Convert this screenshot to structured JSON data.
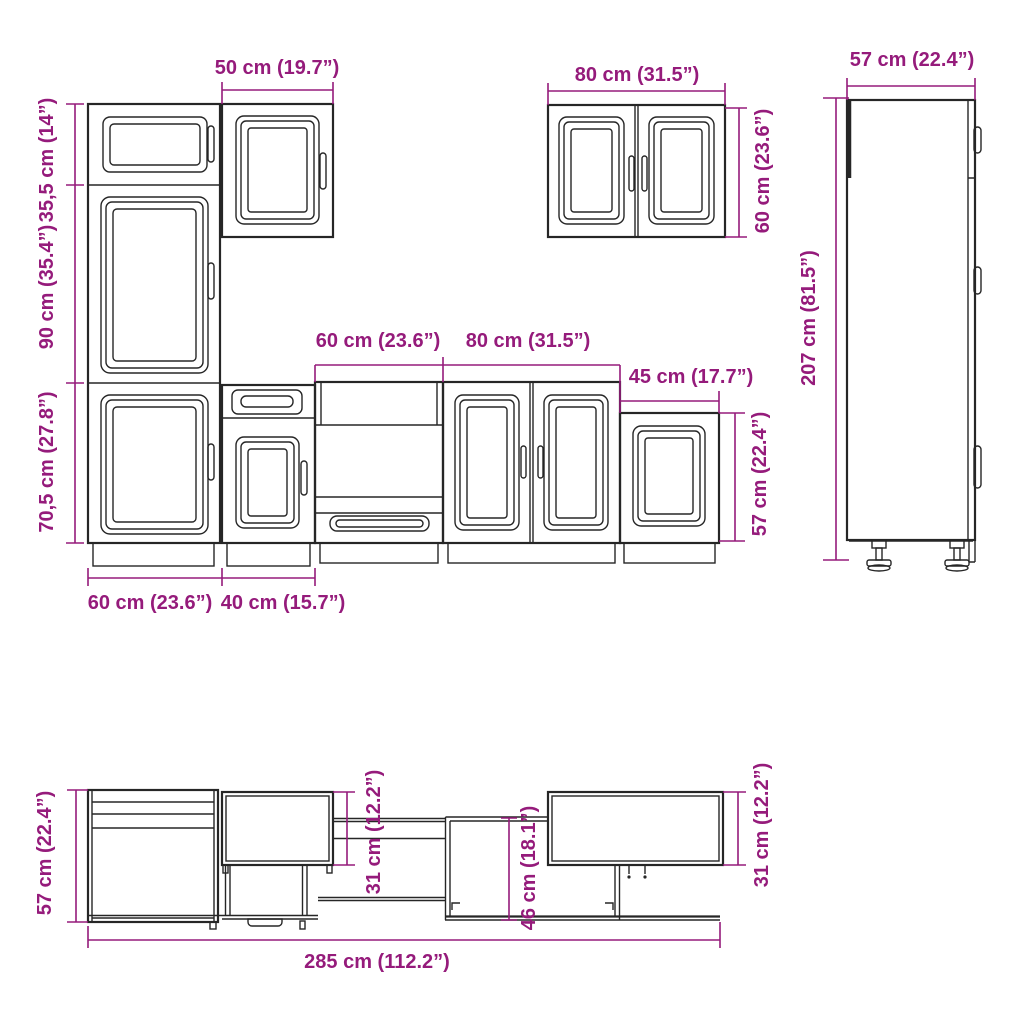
{
  "title": "Kitchen cabinet set dimension diagram",
  "colors": {
    "dimension": "#951b7b",
    "line": "#262626",
    "background": "#ffffff"
  },
  "dimensions": {
    "tall_unit": {
      "width_top": "50 cm (19.7”)",
      "height_top": "35,5 cm (14”)",
      "height_mid": "90 cm (35.4”)",
      "height_bottom": "70,5 cm (27.8”)",
      "width_left": "60 cm (23.6”)",
      "width_right": "40 cm (15.7”)"
    },
    "wall_cabinet_double": {
      "width": "80 cm (31.5”)",
      "height": "60 cm (23.6”)"
    },
    "tall_cabinet_side": {
      "depth": "57 cm (22.4”)",
      "height": "207 cm (81.5”)"
    },
    "base_row": {
      "oven_width": "60 cm (23.6”)",
      "double_width": "80 cm (31.5”)",
      "single_width": "45 cm (17.7”)",
      "height": "57 cm (22.4”)"
    },
    "plan_view": {
      "depth_base": "57 cm (22.4”)",
      "depth_wall_left": "31 cm (12.2”)",
      "depth_mid": "46 cm (18.1”)",
      "depth_wall_right": "31 cm (12.2”)",
      "total_width": "285 cm (112.2”)"
    }
  }
}
